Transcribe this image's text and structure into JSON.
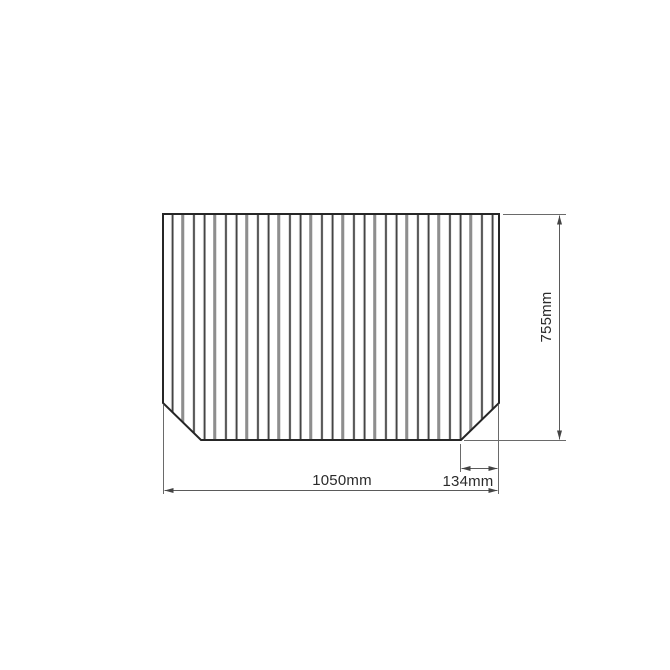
{
  "diagram": {
    "type": "technical-dimension-drawing",
    "subject": "slatted-panel-with-chamfered-bottom-corners",
    "dimensions": {
      "width": {
        "label": "1050mm",
        "value_mm": 1050,
        "orientation": "horizontal"
      },
      "height": {
        "label": "755mm",
        "value_mm": 755,
        "orientation": "vertical"
      },
      "chamfer": {
        "label": "134mm",
        "value_mm": 134,
        "orientation": "horizontal"
      }
    },
    "colors": {
      "background": "#ffffff",
      "panel_outline": "#262626",
      "slat_fill": "#ffffff",
      "slat_line_dark": "#3c3c3c",
      "slat_line_gray": "#8e8e8e",
      "slat_highlight": "#cfcfcf",
      "dimension_line": "#5a5a5a",
      "label_text": "#2b2b2b"
    }
  }
}
